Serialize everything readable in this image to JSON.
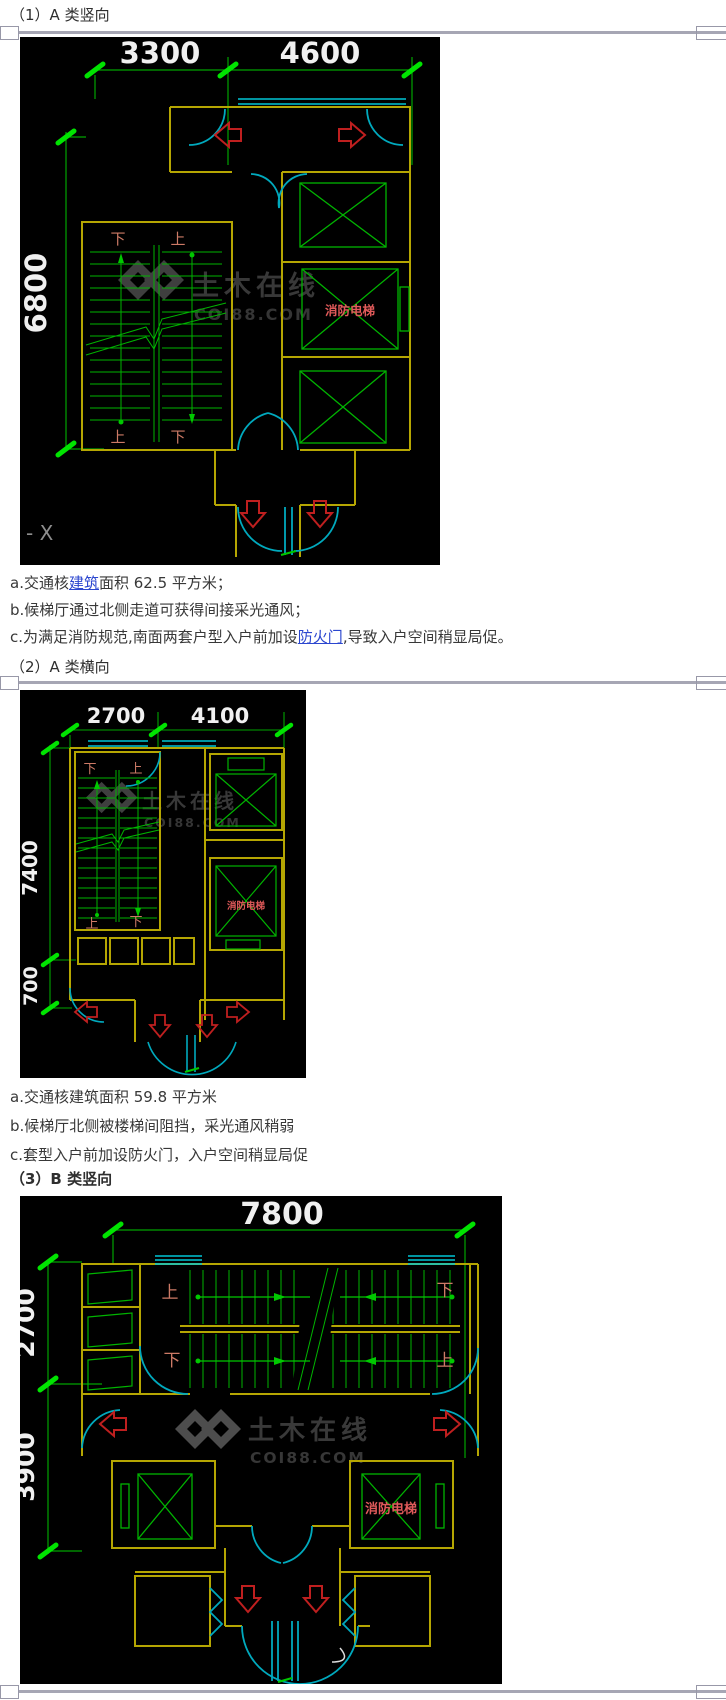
{
  "doc": {
    "s1_heading": "（1）A 类竖向",
    "s2_heading": "（2）A 类横向",
    "s3_heading": "（3）B 类竖向",
    "s1_notes": {
      "a_pre": "a.交通核",
      "a_link": "建筑",
      "a_post": "面积 62.5 平方米；",
      "b": "b.候梯厅通过北侧走道可获得间接采光通风；",
      "c_pre": "c.为满足消防规范,南面两套户型入户前加设",
      "c_link": "防火门",
      "c_post": ",导致入户空间稍显局促。"
    },
    "s2_notes": {
      "a": "a.交通核建筑面积 59.8 平方米",
      "b": "b.候梯厅北侧被楼梯间阻挡，采光通风稍弱",
      "c": "c.套型入户前加设防火门，入户空间稍显局促"
    }
  },
  "drawing1": {
    "dim_top_1": "3300",
    "dim_top_2": "4600",
    "dim_left": "6800",
    "stair_top_left": "下",
    "stair_top_right": "上",
    "stair_bottom_left": "上",
    "stair_bottom_right": "下",
    "fire_elevator": "消防电梯",
    "axis_mark": "- X",
    "wm_cn": "土木在线",
    "wm_en": "COI88.COM"
  },
  "drawing2": {
    "dim_top_1": "2700",
    "dim_top_2": "4100",
    "dim_left_main": "7400",
    "dim_left_small": "700",
    "stair_top_left": "下",
    "stair_top_right": "上",
    "stair_bottom_left": "上",
    "stair_bottom_right": "下",
    "fire_elevator": "消防电梯",
    "wm_cn": "土木在线",
    "wm_en": "COI88.COM"
  },
  "drawing3": {
    "dim_top": "7800",
    "dim_left_top": "2700",
    "dim_left_bottom": "3900",
    "stair_top_left": "上",
    "stair_top_right": "下",
    "stair_bottom_left": "下",
    "stair_bottom_right": "上",
    "fire_elevator": "消防电梯",
    "wm_cn": "土木在线",
    "wm_en": "COI88.COM"
  },
  "colors": {
    "dim_green": "#00a400",
    "tick_green": "#00e400",
    "wall_yellow": "#b5a602",
    "door_cyan": "#00a9bd",
    "arrow_red": "#bf1f1f",
    "label_salmon": "#cd7a66",
    "fire_red": "#e05a5a",
    "link_blue": "#2b46cf",
    "separator_gray": "#a6a6b4"
  }
}
